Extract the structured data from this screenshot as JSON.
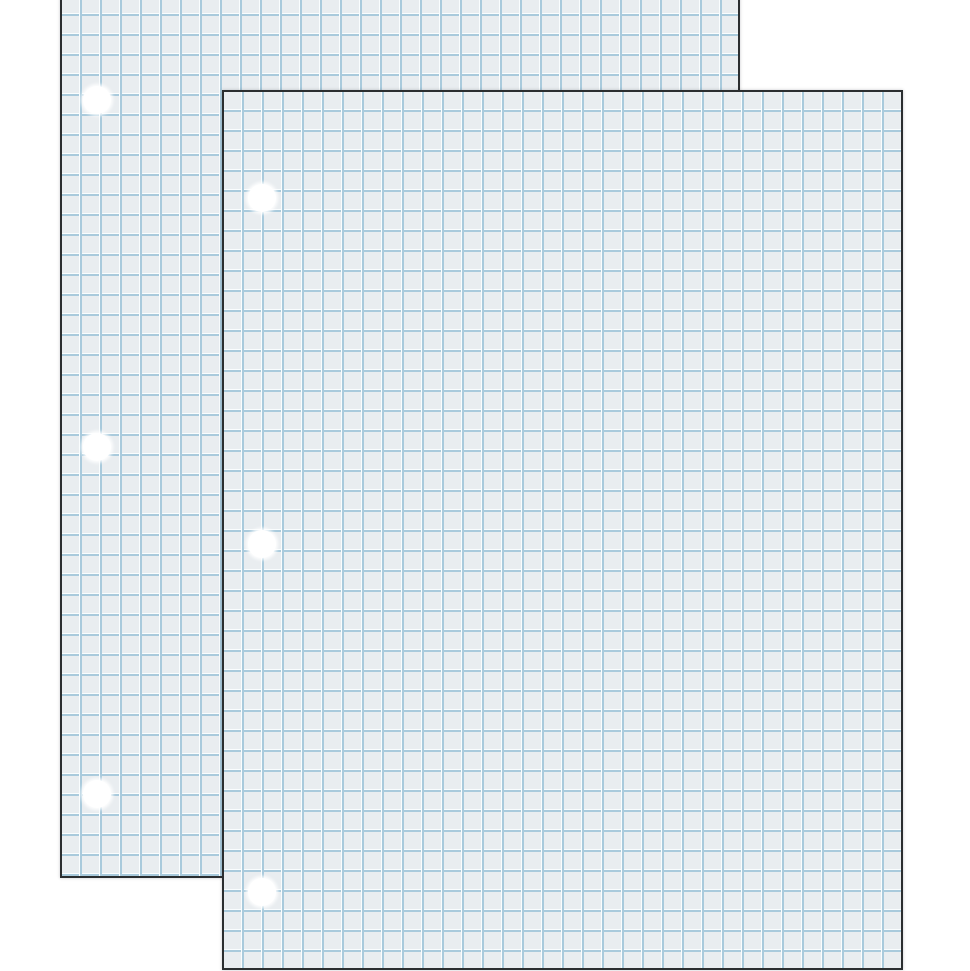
{
  "scene": {
    "description": "Product image: two overlapping sheets of white quad-ruled (graph) filler paper, each 3-hole punched along the left edge, on a plain white background",
    "background_color": "#ffffff"
  },
  "paper": {
    "fill_color": "#e9edf0",
    "grid_line_color": "#a9cadc",
    "grid_highlight_color": "#fafdfe",
    "grid_cell_size_px": 20,
    "border_color": "#2b2e30",
    "border_width_px": 2,
    "hole_color": "#ffffff",
    "hole_diameter_px": 28
  },
  "sheets": [
    {
      "name": "graph-paper-sheet-back",
      "x": 60,
      "y": -6,
      "width": 680,
      "height": 884,
      "holes": [
        {
          "cx": 97,
          "cy": 100
        },
        {
          "cx": 97,
          "cy": 447
        },
        {
          "cx": 97,
          "cy": 794
        }
      ]
    },
    {
      "name": "graph-paper-sheet-front",
      "x": 222,
      "y": 90,
      "width": 681,
      "height": 880,
      "holes": [
        {
          "cx": 262,
          "cy": 198
        },
        {
          "cx": 262,
          "cy": 544
        },
        {
          "cx": 262,
          "cy": 892
        }
      ]
    }
  ]
}
